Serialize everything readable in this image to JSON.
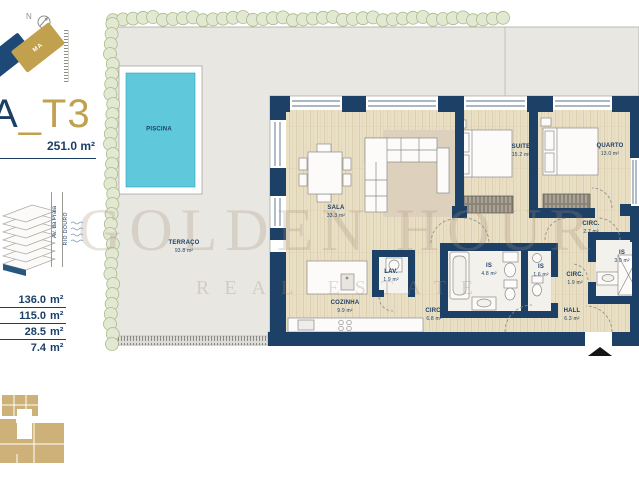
{
  "meta": {
    "title_prefix": "A",
    "title_suffix": "_T3",
    "total_area": "251.0 m²"
  },
  "sidebar": {
    "north_label": "N",
    "block_label": "MA",
    "street_label": "Av. da Praia",
    "river_label": "RIO DOURO",
    "areas": [
      "136.0",
      "115.0",
      "28.5",
      "7.4"
    ],
    "area_unit": "m²"
  },
  "watermark": {
    "line1": "GOLDEN HOUR",
    "line2": "REAL ESTATE"
  },
  "plan": {
    "rooms": [
      {
        "name": "PISCINA",
        "area": "",
        "x": 159,
        "y": 130
      },
      {
        "name": "TERRAÇO",
        "area": "93.8 m²",
        "x": 184,
        "y": 247
      },
      {
        "name": "SALA",
        "area": "33.3 m²",
        "x": 336,
        "y": 212
      },
      {
        "name": "SUITE",
        "area": "15.2 m²",
        "x": 521,
        "y": 151
      },
      {
        "name": "QUARTO",
        "area": "13.0 m²",
        "x": 610,
        "y": 150
      },
      {
        "name": "COZINHA",
        "area": "9.9 m²",
        "x": 345,
        "y": 307
      },
      {
        "name": "LAV.",
        "area": "1.9 m²",
        "x": 391,
        "y": 276
      },
      {
        "name": "IS",
        "area": "4.8 m²",
        "x": 489,
        "y": 270
      },
      {
        "name": "IS",
        "area": "1.6 m²",
        "x": 541,
        "y": 271
      },
      {
        "name": "CIRC.",
        "area": "6.8 m²",
        "x": 434,
        "y": 315
      },
      {
        "name": "CIRC.",
        "area": "2.7 m²",
        "x": 591,
        "y": 228
      },
      {
        "name": "CIRC.",
        "area": "1.9 m²",
        "x": 575,
        "y": 279
      },
      {
        "name": "IS",
        "area": "3.0 m²",
        "x": 622,
        "y": 257
      },
      {
        "name": "HALL",
        "area": "6.3 m²",
        "x": 572,
        "y": 315
      }
    ]
  },
  "colors": {
    "navy": "#1c4066",
    "gold": "#c2a14e",
    "pool": "#5fc8db",
    "wood": "#e9dfc5",
    "terrace": "#e9e7e2",
    "shrub": "#a9bb8c",
    "text_navy": "#1c3f66",
    "keyplan_gold": "#cdb178"
  }
}
